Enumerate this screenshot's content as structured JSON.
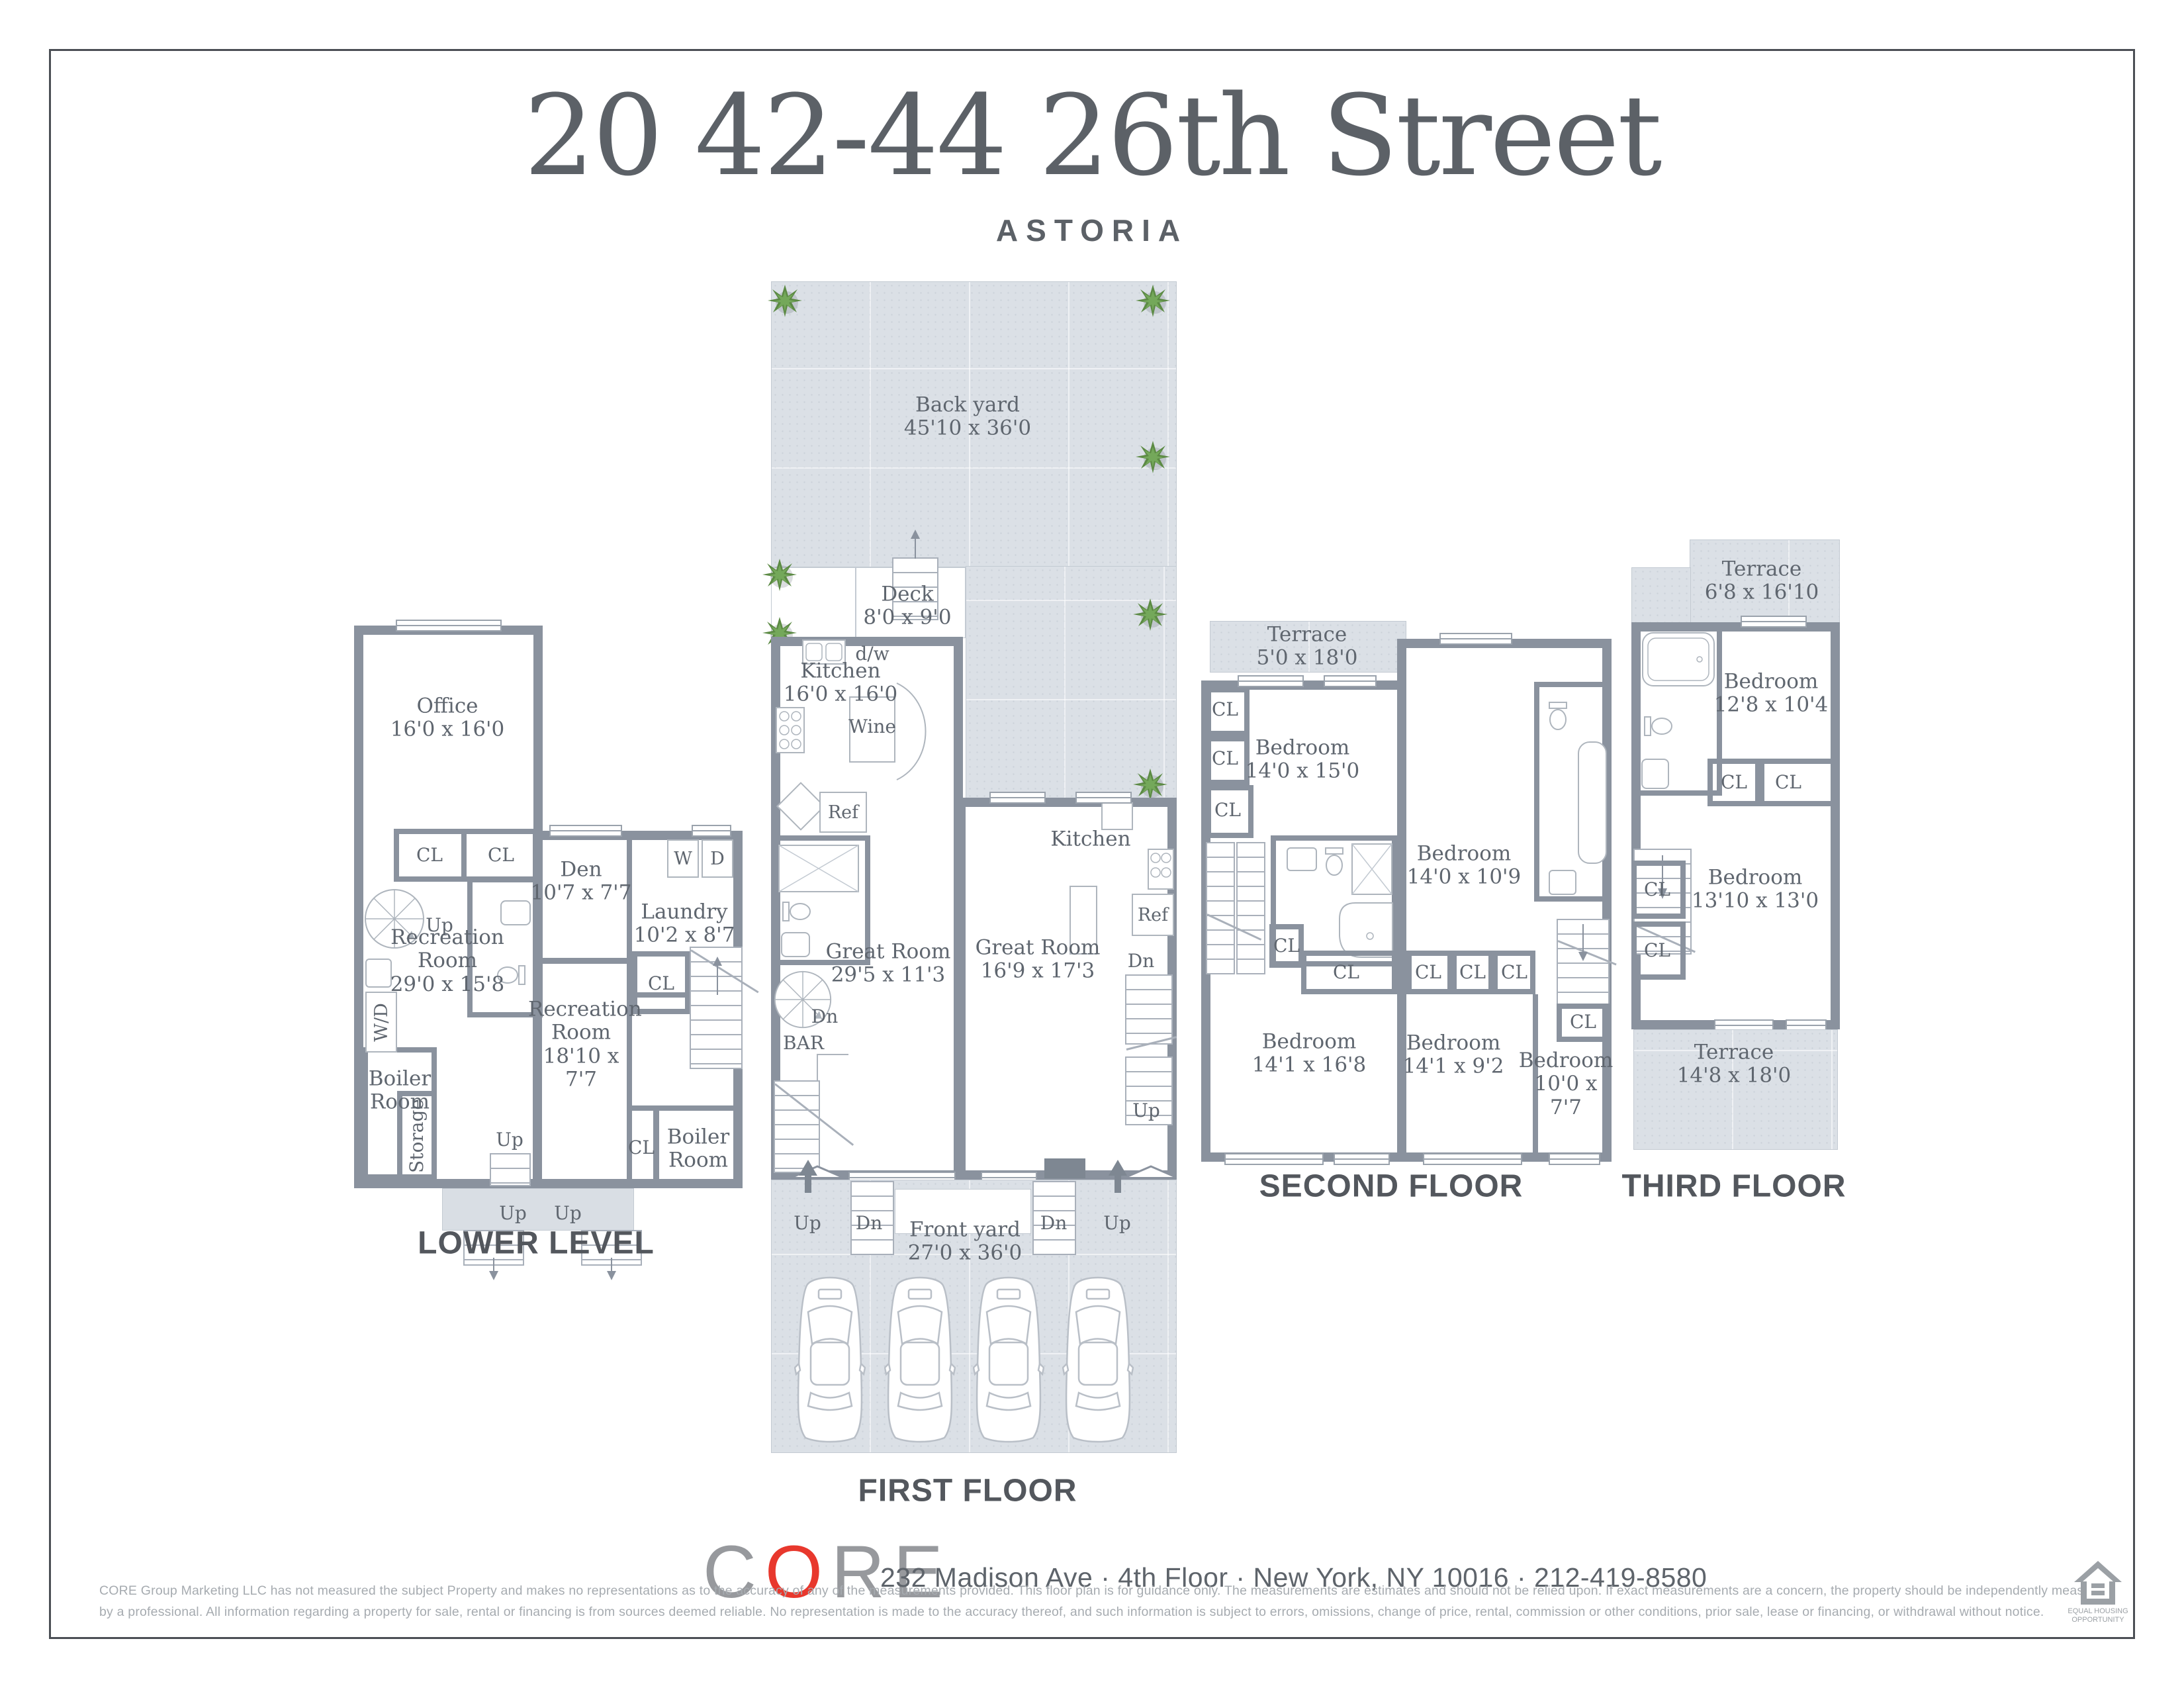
{
  "header": {
    "title": "20 42-44 26th Street",
    "subtitle": "ASTORIA"
  },
  "colors": {
    "wall": "#8A929E",
    "yard": "#DBE0E6",
    "accent_red": "#E8382D",
    "frame": "#4B4F55",
    "label": "#5F666F"
  },
  "labels": {
    "cl": "CL",
    "up": "Up",
    "dn": "Dn",
    "ref": "Ref",
    "w": "W",
    "d": "D",
    "wd": "W/D",
    "dw": "d/w",
    "wine": "Wine",
    "bar": "BAR",
    "storage": "Storage",
    "kitchen": "Kitchen"
  },
  "floors": {
    "lower": {
      "title": "LOWER LEVEL",
      "office": {
        "name": "Office",
        "dims": "16'0 x 16'0"
      },
      "den": {
        "name": "Den",
        "dims": "10'7 x 7'7"
      },
      "laundry": {
        "name": "Laundry",
        "dims": "10'2 x 8'7"
      },
      "rec1": {
        "name": "Recreation Room",
        "dims": "29'0 x 15'8"
      },
      "rec2": {
        "name": "Recreation Room",
        "dims": "18'10 x 7'7"
      },
      "boiler": {
        "name": "Boiler Room"
      }
    },
    "first": {
      "title": "FIRST FLOOR",
      "backyard": {
        "name": "Back yard",
        "dims": "45'10 x 36'0"
      },
      "deck": {
        "name": "Deck",
        "dims": "8'0 x 9'0"
      },
      "kitchen1": {
        "name": "Kitchen",
        "dims": "16'0 x 16'0"
      },
      "great1": {
        "name": "Great Room",
        "dims": "29'5 x 11'3"
      },
      "great2": {
        "name": "Great Room",
        "dims": "16'9 x 17'3"
      },
      "frontyard": {
        "name": "Front yard",
        "dims": "27'0 x 36'0"
      }
    },
    "second": {
      "title": "SECOND FLOOR",
      "terrace": {
        "name": "Terrace",
        "dims": "5'0 x 18'0"
      },
      "bed1": {
        "name": "Bedroom",
        "dims": "14'0 x 15'0"
      },
      "bed2": {
        "name": "Bedroom",
        "dims": "14'0 x 10'9"
      },
      "bed3": {
        "name": "Bedroom",
        "dims": "14'1 x 16'8"
      },
      "bed4": {
        "name": "Bedroom",
        "dims": "14'1 x 9'2"
      },
      "bed5": {
        "name": "Bedroom",
        "dims": "10'0 x 7'7"
      }
    },
    "third": {
      "title": "THIRD FLOOR",
      "terrace1": {
        "name": "Terrace",
        "dims": "6'8 x 16'10"
      },
      "bed1": {
        "name": "Bedroom",
        "dims": "12'8 x 10'4"
      },
      "bed2": {
        "name": "Bedroom",
        "dims": "13'10 x 13'0"
      },
      "terrace2": {
        "name": "Terrace",
        "dims": "14'8 x 18'0"
      }
    }
  },
  "footer": {
    "logo": {
      "c": "C",
      "o": "O",
      "re": "RE"
    },
    "address": "232 Madison Ave · 4th Floor · New York, NY 10016 · 212-419-8580",
    "disclaimer1": "CORE Group Marketing LLC has not measured the subject Property and makes no representations as to the accuracy of any of the measurements provided. This floor plan is for guidance only. The measurements are estimates and should not be relied upon. If exact measurements are a concern, the property should be independently measured",
    "disclaimer2": "by a professional. All information regarding a property for sale, rental or financing is from sources deemed reliable.  No representation is made to the accuracy thereof, and such information is subject to errors, omissions, change of price, rental, commission or other conditions, prior sale, lease or financing, or withdrawal without notice.",
    "eho1": "EQUAL HOUSING",
    "eho2": "OPPORTUNITY"
  }
}
